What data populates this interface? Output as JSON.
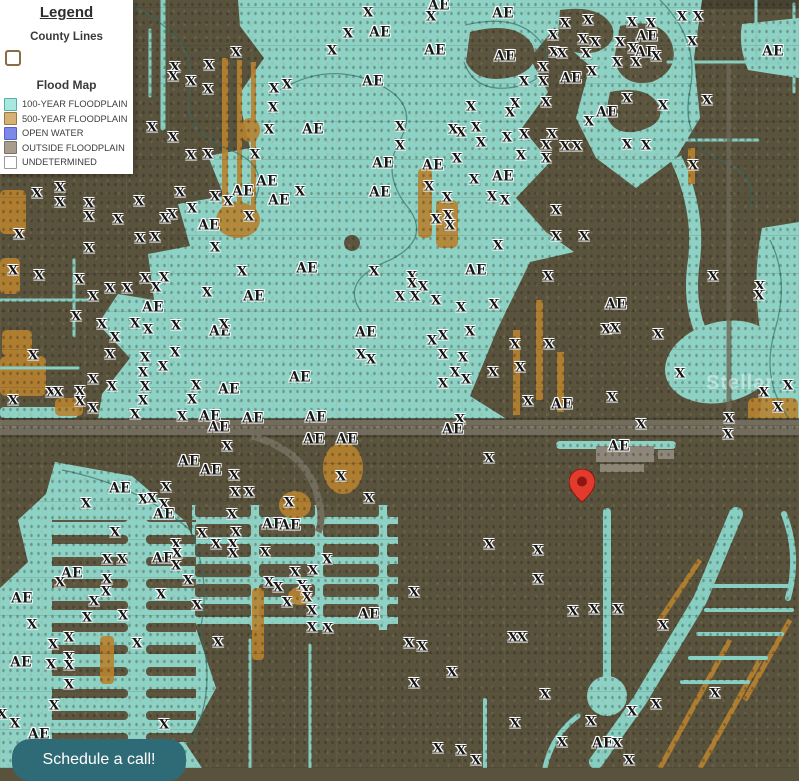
{
  "legend": {
    "title": "Legend",
    "county": {
      "heading": "County Lines",
      "swatch_border": "#8a6d42"
    },
    "flood": {
      "heading": "Flood Map",
      "items": [
        {
          "label": "100-YEAR FLOODPLAIN",
          "fill": "#a7e9df",
          "border": "#54b0a4"
        },
        {
          "label": "500-YEAR FLOODPLAIN",
          "fill": "#d6b176",
          "border": "#9b7a3e"
        },
        {
          "label": "OPEN WATER",
          "fill": "#7d88e8",
          "border": "#5560cf"
        },
        {
          "label": "OUTSIDE FLOODPLAIN",
          "fill": "#a79c8d",
          "border": "#7c7365"
        },
        {
          "label": "UNDETERMINED",
          "fill": "#ffffff",
          "border": "#9a9a9a"
        }
      ]
    }
  },
  "cta": {
    "label": "Schedule a call!",
    "bg": "#2f6b76"
  },
  "map": {
    "watermark": "Stellar",
    "marker": {
      "x": 582,
      "y": 501,
      "color": "#e23b2e",
      "inner": "#8e1610"
    },
    "zone_colors": {
      "floodplain_100": "#8ed2c5",
      "floodplain_500": "#b8822f",
      "open_water": "#7d88e8",
      "outside_floodplain": "#59523d",
      "highway": "#716c5c"
    },
    "labels": [
      [
        368,
        13,
        "X"
      ],
      [
        348,
        34,
        "X"
      ],
      [
        380,
        33,
        "AE"
      ],
      [
        332,
        51,
        "X"
      ],
      [
        236,
        53,
        "X"
      ],
      [
        439,
        6,
        "AE"
      ],
      [
        431,
        17,
        "X"
      ],
      [
        503,
        14,
        "AE"
      ],
      [
        565,
        24,
        "X"
      ],
      [
        588,
        21,
        "X"
      ],
      [
        632,
        23,
        "X"
      ],
      [
        651,
        24,
        "X"
      ],
      [
        682,
        17,
        "X"
      ],
      [
        698,
        17,
        "X"
      ],
      [
        553,
        36,
        "X"
      ],
      [
        647,
        37,
        "AE"
      ],
      [
        583,
        40,
        "X"
      ],
      [
        595,
        43,
        "X"
      ],
      [
        620,
        43,
        "X"
      ],
      [
        692,
        42,
        "X"
      ],
      [
        435,
        51,
        "AE"
      ],
      [
        505,
        57,
        "AE"
      ],
      [
        554,
        53,
        "X"
      ],
      [
        562,
        54,
        "X"
      ],
      [
        586,
        54,
        "X"
      ],
      [
        633,
        49,
        "X"
      ],
      [
        646,
        53,
        "AE"
      ],
      [
        656,
        57,
        "X"
      ],
      [
        773,
        52,
        "AE"
      ],
      [
        175,
        68,
        "X"
      ],
      [
        209,
        66,
        "X"
      ],
      [
        173,
        77,
        "X"
      ],
      [
        191,
        82,
        "X"
      ],
      [
        208,
        90,
        "X"
      ],
      [
        287,
        85,
        "X"
      ],
      [
        274,
        89,
        "X"
      ],
      [
        373,
        82,
        "AE"
      ],
      [
        543,
        68,
        "X"
      ],
      [
        617,
        63,
        "X"
      ],
      [
        636,
        63,
        "X"
      ],
      [
        592,
        72,
        "X"
      ],
      [
        524,
        82,
        "X"
      ],
      [
        543,
        82,
        "X"
      ],
      [
        571,
        79,
        "AE"
      ],
      [
        273,
        108,
        "X"
      ],
      [
        515,
        104,
        "X"
      ],
      [
        510,
        113,
        "X"
      ],
      [
        471,
        107,
        "X"
      ],
      [
        546,
        103,
        "X"
      ],
      [
        627,
        99,
        "X"
      ],
      [
        663,
        106,
        "X"
      ],
      [
        707,
        101,
        "X"
      ],
      [
        607,
        113,
        "AE"
      ],
      [
        269,
        130,
        "X"
      ],
      [
        313,
        130,
        "AE"
      ],
      [
        152,
        128,
        "X"
      ],
      [
        173,
        138,
        "X"
      ],
      [
        589,
        122,
        "X"
      ],
      [
        400,
        127,
        "X"
      ],
      [
        453,
        130,
        "X"
      ],
      [
        461,
        133,
        "X"
      ],
      [
        476,
        128,
        "X"
      ],
      [
        191,
        156,
        "X"
      ],
      [
        208,
        155,
        "X"
      ],
      [
        255,
        155,
        "X"
      ],
      [
        383,
        164,
        "AE"
      ],
      [
        481,
        143,
        "X"
      ],
      [
        507,
        138,
        "X"
      ],
      [
        524,
        135,
        "X"
      ],
      [
        552,
        135,
        "X"
      ],
      [
        546,
        146,
        "X"
      ],
      [
        565,
        147,
        "X"
      ],
      [
        577,
        147,
        "X"
      ],
      [
        627,
        145,
        "X"
      ],
      [
        646,
        146,
        "X"
      ],
      [
        400,
        146,
        "X"
      ],
      [
        457,
        159,
        "X"
      ],
      [
        521,
        156,
        "X"
      ],
      [
        546,
        159,
        "X"
      ],
      [
        693,
        166,
        "X"
      ],
      [
        433,
        166,
        "AE"
      ],
      [
        267,
        182,
        "AE"
      ],
      [
        243,
        192,
        "AE"
      ],
      [
        37,
        194,
        "X"
      ],
      [
        60,
        188,
        "X"
      ],
      [
        60,
        203,
        "X"
      ],
      [
        89,
        204,
        "X"
      ],
      [
        139,
        202,
        "X"
      ],
      [
        180,
        193,
        "X"
      ],
      [
        215,
        197,
        "X"
      ],
      [
        228,
        202,
        "X"
      ],
      [
        279,
        201,
        "AE"
      ],
      [
        300,
        192,
        "X"
      ],
      [
        380,
        193,
        "AE"
      ],
      [
        429,
        187,
        "X"
      ],
      [
        474,
        180,
        "X"
      ],
      [
        503,
        177,
        "AE"
      ],
      [
        447,
        198,
        "X"
      ],
      [
        492,
        197,
        "X"
      ],
      [
        505,
        201,
        "X"
      ],
      [
        192,
        209,
        "X"
      ],
      [
        172,
        215,
        "X"
      ],
      [
        165,
        219,
        "X"
      ],
      [
        249,
        217,
        "X"
      ],
      [
        209,
        226,
        "AE"
      ],
      [
        19,
        235,
        "X"
      ],
      [
        89,
        217,
        "X"
      ],
      [
        118,
        220,
        "X"
      ],
      [
        140,
        239,
        "X"
      ],
      [
        155,
        238,
        "X"
      ],
      [
        89,
        249,
        "X"
      ],
      [
        215,
        248,
        "X"
      ],
      [
        556,
        211,
        "X"
      ],
      [
        436,
        220,
        "X"
      ],
      [
        448,
        216,
        "X"
      ],
      [
        450,
        226,
        "X"
      ],
      [
        556,
        237,
        "X"
      ],
      [
        584,
        237,
        "X"
      ],
      [
        498,
        246,
        "X"
      ],
      [
        13,
        271,
        "X"
      ],
      [
        39,
        276,
        "X"
      ],
      [
        79,
        280,
        "X"
      ],
      [
        110,
        289,
        "X"
      ],
      [
        127,
        289,
        "X"
      ],
      [
        145,
        279,
        "X"
      ],
      [
        164,
        278,
        "X"
      ],
      [
        156,
        288,
        "X"
      ],
      [
        93,
        297,
        "X"
      ],
      [
        207,
        293,
        "X"
      ],
      [
        242,
        272,
        "X"
      ],
      [
        307,
        269,
        "AE"
      ],
      [
        374,
        272,
        "X"
      ],
      [
        476,
        271,
        "AE"
      ],
      [
        548,
        277,
        "X"
      ],
      [
        412,
        277,
        "X"
      ],
      [
        412,
        284,
        "X"
      ],
      [
        423,
        287,
        "X"
      ],
      [
        415,
        297,
        "X"
      ],
      [
        400,
        297,
        "X"
      ],
      [
        254,
        297,
        "AE"
      ],
      [
        153,
        308,
        "AE"
      ],
      [
        76,
        317,
        "X"
      ],
      [
        102,
        325,
        "X"
      ],
      [
        135,
        324,
        "X"
      ],
      [
        436,
        301,
        "X"
      ],
      [
        461,
        308,
        "X"
      ],
      [
        494,
        305,
        "X"
      ],
      [
        616,
        305,
        "AE"
      ],
      [
        713,
        277,
        "X"
      ],
      [
        760,
        287,
        "X"
      ],
      [
        759,
        296,
        "X"
      ],
      [
        148,
        330,
        "X"
      ],
      [
        176,
        326,
        "X"
      ],
      [
        220,
        332,
        "AE"
      ],
      [
        224,
        325,
        "X"
      ],
      [
        366,
        333,
        "AE"
      ],
      [
        470,
        332,
        "X"
      ],
      [
        443,
        336,
        "X"
      ],
      [
        432,
        341,
        "X"
      ],
      [
        606,
        330,
        "X"
      ],
      [
        615,
        329,
        "X"
      ],
      [
        658,
        335,
        "X"
      ],
      [
        115,
        338,
        "X"
      ],
      [
        110,
        355,
        "X"
      ],
      [
        33,
        356,
        "X"
      ],
      [
        175,
        353,
        "X"
      ],
      [
        145,
        358,
        "X"
      ],
      [
        163,
        367,
        "X"
      ],
      [
        143,
        373,
        "X"
      ],
      [
        361,
        355,
        "X"
      ],
      [
        371,
        360,
        "X"
      ],
      [
        515,
        345,
        "X"
      ],
      [
        549,
        345,
        "X"
      ],
      [
        443,
        355,
        "X"
      ],
      [
        463,
        358,
        "X"
      ],
      [
        520,
        368,
        "X"
      ],
      [
        455,
        373,
        "X"
      ],
      [
        443,
        384,
        "X"
      ],
      [
        466,
        380,
        "X"
      ],
      [
        493,
        373,
        "X"
      ],
      [
        680,
        374,
        "X"
      ],
      [
        93,
        380,
        "X"
      ],
      [
        112,
        387,
        "X"
      ],
      [
        51,
        393,
        "X"
      ],
      [
        58,
        393,
        "X"
      ],
      [
        80,
        392,
        "X"
      ],
      [
        13,
        401,
        "X"
      ],
      [
        80,
        402,
        "X"
      ],
      [
        145,
        387,
        "X"
      ],
      [
        143,
        401,
        "X"
      ],
      [
        93,
        409,
        "X"
      ],
      [
        196,
        386,
        "X"
      ],
      [
        192,
        400,
        "X"
      ],
      [
        229,
        390,
        "AE"
      ],
      [
        300,
        378,
        "AE"
      ],
      [
        612,
        398,
        "X"
      ],
      [
        528,
        402,
        "X"
      ],
      [
        562,
        405,
        "AE"
      ],
      [
        764,
        393,
        "X"
      ],
      [
        788,
        386,
        "X"
      ],
      [
        778,
        408,
        "X"
      ],
      [
        135,
        415,
        "X"
      ],
      [
        182,
        417,
        "X"
      ],
      [
        210,
        417,
        "AE"
      ],
      [
        219,
        428,
        "AE"
      ],
      [
        253,
        419,
        "AE"
      ],
      [
        316,
        418,
        "AE"
      ],
      [
        460,
        420,
        "X"
      ],
      [
        453,
        430,
        "AE"
      ],
      [
        641,
        425,
        "X"
      ],
      [
        729,
        419,
        "X"
      ],
      [
        314,
        440,
        "AE"
      ],
      [
        347,
        440,
        "AE"
      ],
      [
        227,
        447,
        "X"
      ],
      [
        728,
        435,
        "X"
      ],
      [
        189,
        462,
        "AE"
      ],
      [
        211,
        471,
        "AE"
      ],
      [
        234,
        476,
        "X"
      ],
      [
        619,
        447,
        "AE"
      ],
      [
        120,
        489,
        "AE"
      ],
      [
        166,
        488,
        "X"
      ],
      [
        143,
        500,
        "X"
      ],
      [
        152,
        499,
        "X"
      ],
      [
        164,
        505,
        "X"
      ],
      [
        235,
        493,
        "X"
      ],
      [
        249,
        493,
        "X"
      ],
      [
        86,
        504,
        "X"
      ],
      [
        289,
        503,
        "X"
      ],
      [
        341,
        477,
        "X"
      ],
      [
        369,
        499,
        "X"
      ],
      [
        489,
        459,
        "X"
      ],
      [
        164,
        515,
        "AE"
      ],
      [
        232,
        515,
        "X"
      ],
      [
        273,
        525,
        "AE"
      ],
      [
        290,
        526,
        "AE"
      ],
      [
        115,
        533,
        "X"
      ],
      [
        202,
        534,
        "X"
      ],
      [
        236,
        533,
        "X"
      ],
      [
        489,
        545,
        "X"
      ],
      [
        538,
        551,
        "X"
      ],
      [
        176,
        545,
        "X"
      ],
      [
        216,
        545,
        "X"
      ],
      [
        233,
        545,
        "X"
      ],
      [
        107,
        560,
        "X"
      ],
      [
        122,
        560,
        "X"
      ],
      [
        163,
        559,
        "AE"
      ],
      [
        177,
        554,
        "X"
      ],
      [
        233,
        554,
        "X"
      ],
      [
        265,
        553,
        "X"
      ],
      [
        327,
        560,
        "X"
      ],
      [
        72,
        574,
        "AE"
      ],
      [
        60,
        583,
        "X"
      ],
      [
        107,
        580,
        "X"
      ],
      [
        176,
        566,
        "X"
      ],
      [
        188,
        581,
        "X"
      ],
      [
        295,
        573,
        "X"
      ],
      [
        313,
        571,
        "X"
      ],
      [
        538,
        580,
        "X"
      ],
      [
        414,
        593,
        "X"
      ],
      [
        269,
        583,
        "X"
      ],
      [
        278,
        588,
        "X"
      ],
      [
        302,
        586,
        "X"
      ],
      [
        306,
        591,
        "X"
      ],
      [
        106,
        592,
        "X"
      ],
      [
        161,
        595,
        "X"
      ],
      [
        22,
        599,
        "AE"
      ],
      [
        94,
        602,
        "X"
      ],
      [
        307,
        598,
        "X"
      ],
      [
        287,
        603,
        "X"
      ],
      [
        197,
        606,
        "X"
      ],
      [
        312,
        611,
        "X"
      ],
      [
        369,
        615,
        "AE"
      ],
      [
        573,
        612,
        "X"
      ],
      [
        594,
        610,
        "X"
      ],
      [
        618,
        610,
        "X"
      ],
      [
        663,
        626,
        "X"
      ],
      [
        87,
        618,
        "X"
      ],
      [
        123,
        616,
        "X"
      ],
      [
        32,
        625,
        "X"
      ],
      [
        312,
        628,
        "X"
      ],
      [
        328,
        629,
        "X"
      ],
      [
        69,
        638,
        "X"
      ],
      [
        53,
        645,
        "X"
      ],
      [
        137,
        644,
        "X"
      ],
      [
        218,
        643,
        "X"
      ],
      [
        409,
        644,
        "X"
      ],
      [
        422,
        647,
        "X"
      ],
      [
        513,
        638,
        "X"
      ],
      [
        522,
        638,
        "X"
      ],
      [
        21,
        663,
        "AE"
      ],
      [
        51,
        665,
        "X"
      ],
      [
        69,
        658,
        "X"
      ],
      [
        69,
        666,
        "X"
      ],
      [
        69,
        685,
        "X"
      ],
      [
        452,
        673,
        "X"
      ],
      [
        414,
        684,
        "X"
      ],
      [
        54,
        706,
        "X"
      ],
      [
        2,
        715,
        "X"
      ],
      [
        15,
        724,
        "X"
      ],
      [
        39,
        735,
        "AE"
      ],
      [
        164,
        725,
        "X"
      ],
      [
        545,
        695,
        "X"
      ],
      [
        715,
        694,
        "X"
      ],
      [
        632,
        712,
        "X"
      ],
      [
        656,
        705,
        "X"
      ],
      [
        515,
        724,
        "X"
      ],
      [
        591,
        722,
        "X"
      ],
      [
        562,
        743,
        "X"
      ],
      [
        603,
        744,
        "AE"
      ],
      [
        617,
        744,
        "X"
      ],
      [
        629,
        761,
        "X"
      ],
      [
        438,
        749,
        "X"
      ],
      [
        461,
        751,
        "X"
      ],
      [
        476,
        761,
        "X"
      ]
    ]
  }
}
